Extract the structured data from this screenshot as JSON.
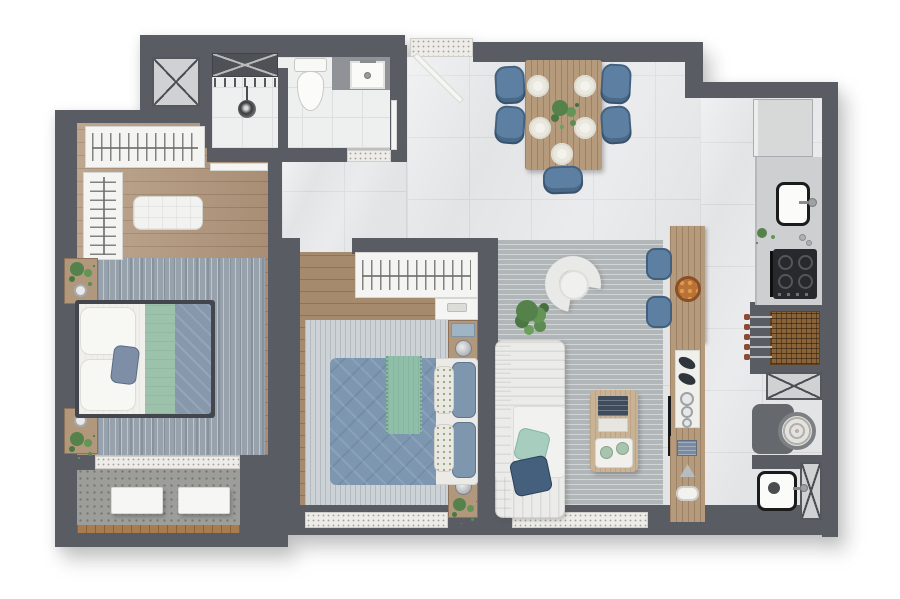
{
  "meta": {
    "image_type": "3d-rendered apartment floor plan, top-down view",
    "canvas": "900x599"
  },
  "colors": {
    "wall": "#595c62",
    "tile_floor": "#e3e4e6",
    "bath_tile": "#eef0f0",
    "wood_floor": "#b3977c",
    "wood_floor_dark": "#a68a6e",
    "counter_wood": "#b69a7c",
    "balcony_concrete": "#9d9d9a",
    "rug_living": "#b1b6b9",
    "rug_bedroom1": "#97a2ac",
    "rug_bedroom2": "#ccd2d6",
    "chair_blue": "#5d80a2",
    "pillow_navy": "#44607d",
    "pillow_mint": "#a7cdbe",
    "blanket_green": "#9cc2ab",
    "duvet_blue1": "#8798ac",
    "duvet_blue2": "#7e97b1",
    "appliance_dark": "#28292c",
    "grill_wood": "#8a6438",
    "sofa_white": "#ebebe9",
    "plant_green": "#55814b"
  },
  "rooms": [
    {
      "id": "bathroom",
      "furniture": [
        "shower",
        "shower-head",
        "toilet",
        "vanity-sink",
        "vent-shaft"
      ]
    },
    {
      "id": "bedroom-1",
      "furniture": [
        "wardrobe-top",
        "wardrobe-left",
        "bench",
        "double-bed",
        "nightstand-upper",
        "nightstand-lower",
        "rug"
      ]
    },
    {
      "id": "bedroom-2",
      "furniture": [
        "wardrobe",
        "shelf-niche",
        "nightstand-upper",
        "nightstand-lower",
        "double-bed",
        "rug"
      ]
    },
    {
      "id": "living-room",
      "furniture": [
        "sofa",
        "armchair",
        "coffee-table",
        "floor-plant",
        "rug"
      ]
    },
    {
      "id": "dining-area",
      "furniture": [
        "dining-table",
        "chair-x5",
        "place-setting-x5",
        "centerpiece-plant"
      ]
    },
    {
      "id": "kitchen",
      "furniture": [
        "refrigerator",
        "sink",
        "cooktop",
        "barbecue-grill",
        "island-counter",
        "bar-stool-x2",
        "open-shelves"
      ]
    },
    {
      "id": "laundry",
      "furniture": [
        "washer",
        "laundry-basket",
        "utility-tank",
        "service-shaft"
      ]
    },
    {
      "id": "balcony",
      "furniture": [
        "bench-seat-x2",
        "wood-deck-edge"
      ]
    },
    {
      "id": "hallway",
      "furniture": []
    },
    {
      "id": "entry",
      "furniture": [
        "doormat",
        "entry-door"
      ]
    }
  ]
}
